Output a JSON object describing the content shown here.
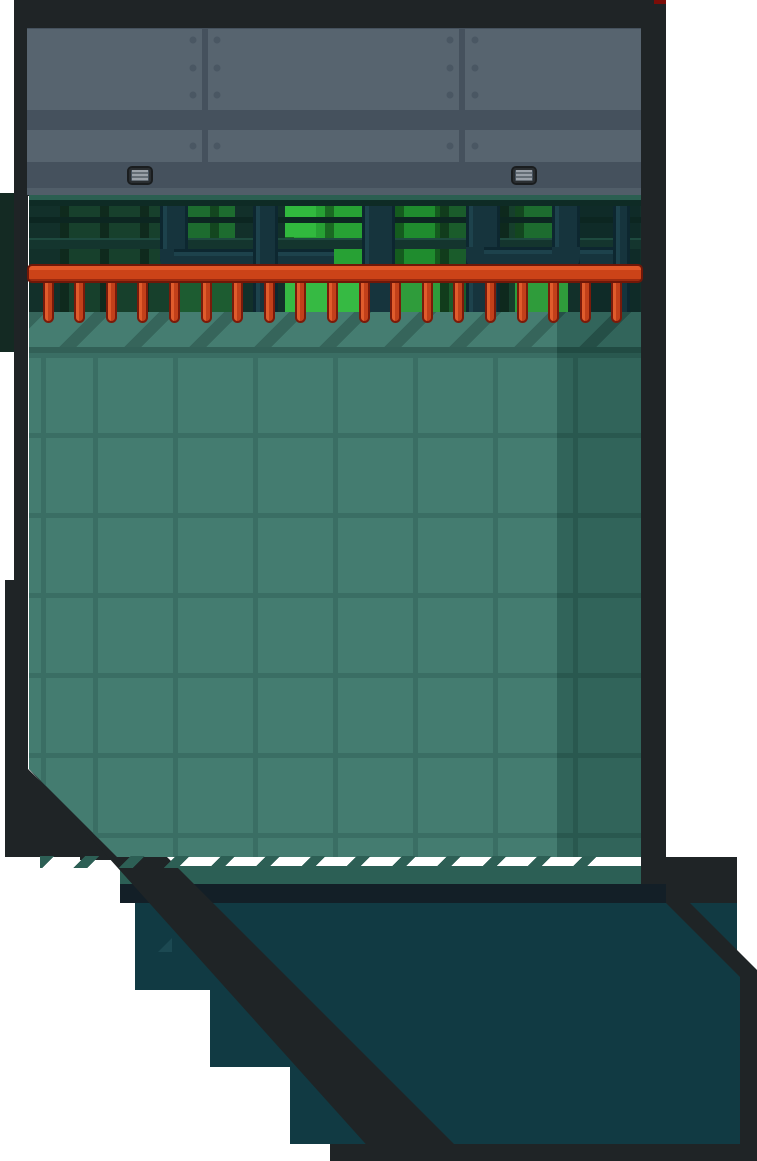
{
  "scene": {
    "title": "Industrial spike-trap room",
    "environment": "2D platformer game level segment",
    "visible_text": "",
    "regions": {
      "top": "riveted metal plate wall with two air vents",
      "middle": "dark machine window with glowing green panes and steel pipes",
      "trap": "red horizontal pipe bar with hanging spike prongs",
      "pit": "large teal tiled wall with diagonal hazard hatching top and bottom",
      "bottom": "dark teal floor cavity cut by diagonal dark frame bands, stepped edges"
    }
  },
  "structures": {
    "wall_panels": {
      "rows": 2,
      "vertical_seams": 2,
      "rivet_count": 16
    },
    "vents": {
      "count": 2
    },
    "spike_bar": {
      "spike_count": 19,
      "spike_spacing_px": 31.6,
      "first_spike_center_x": 48
    },
    "window": {
      "green_pane_groups": 7,
      "pipe_columns": 6,
      "elbows": 3,
      "rails": 2
    },
    "tiles": {
      "grid_pitch_px": 80,
      "hatch_angle_deg": 45
    },
    "floor_steps": {
      "count": 3
    }
  },
  "colors": {
    "background": "#FFFFFF",
    "frame_dark": "#1F2426",
    "panel": "#57646F",
    "panel_gap": "#45515D",
    "rivet": "#4A5763",
    "vent_body": "#9AA1A9",
    "window_strip": "#2B5F51",
    "window_bg": "#12302A",
    "green_dim": "#17402C",
    "green_med": "#1D6C2F",
    "green_bright": "#27A134",
    "green_brightest": "#33BC40",
    "pipe": "#16343D",
    "spike_red": "#CC4318",
    "spike_outline": "#701708",
    "tile_base": "#3A7569",
    "tile_grid": "#30675C",
    "hatch_stripe": "#2C5D53",
    "mid_band": "#2C5F55",
    "dark_strip": "#131F27",
    "floor_teal": "#113A43",
    "notch_teal": "#1C4952",
    "red_sliver": "#7B0D08",
    "left_duct": "#142A23"
  }
}
